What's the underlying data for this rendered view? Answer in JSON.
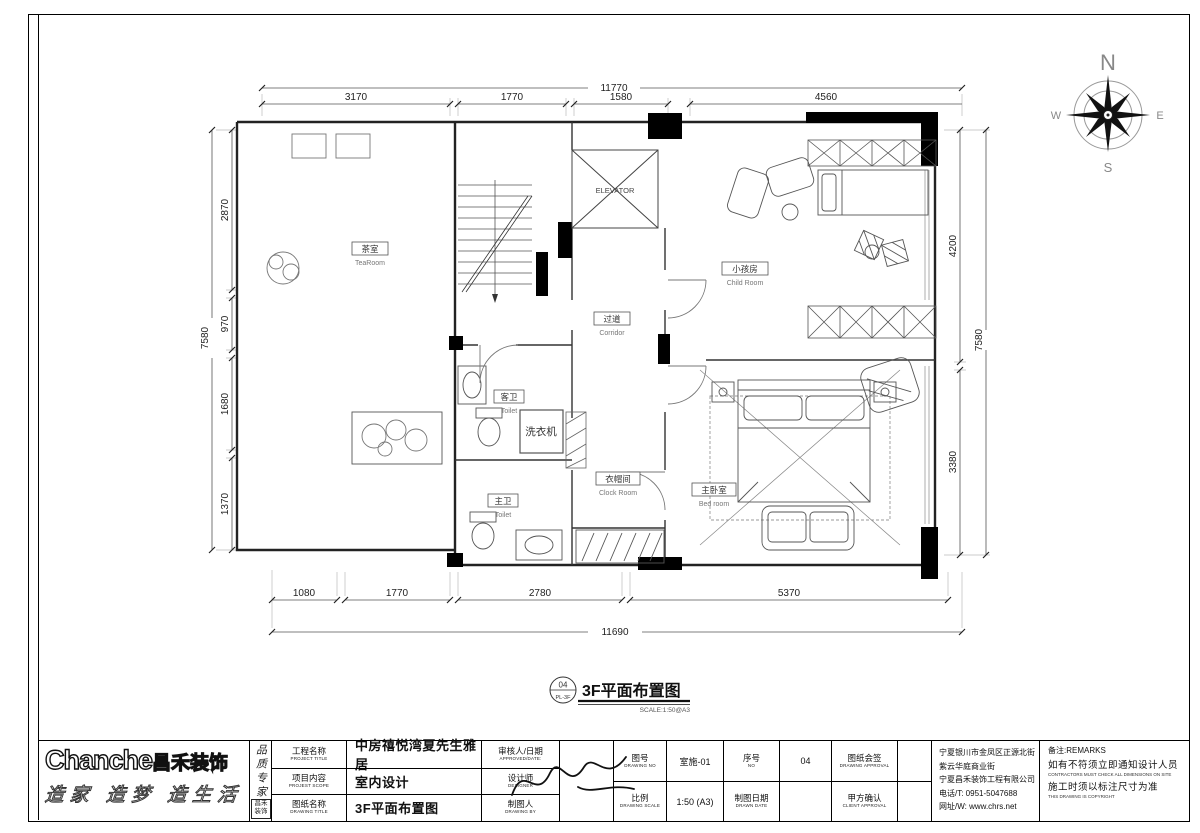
{
  "compass": {
    "n": "N",
    "e": "E",
    "s": "S",
    "w": "W"
  },
  "plan": {
    "labels": {
      "tearoom_cn": "茶室",
      "tearoom_en": "TeaRoom",
      "elevator": "ELEVATOR",
      "child_cn": "小孩房",
      "child_en": "Child Room",
      "corridor_cn": "过道",
      "corridor_en": "Corridor",
      "toilet1_cn": "客卫",
      "toilet1_en": "Toilet",
      "washer": "洗衣机",
      "toilet2_cn": "主卫",
      "toilet2_en": "Toilet",
      "cloak_cn": "衣帽间",
      "cloak_en": "Clock Room",
      "bedroom_cn": "主卧室",
      "bedroom_en": "Bed room"
    },
    "dims": {
      "top_total": "11770",
      "top_seg": [
        "3170",
        "1770",
        "1580",
        "4560"
      ],
      "bottom_total": "11690",
      "bottom_seg": [
        "1080",
        "1770",
        "2780",
        "5370"
      ],
      "left_total": "7580",
      "left_seg": [
        "2870",
        "970",
        "1680",
        "1370"
      ],
      "right_total": "7580",
      "right_seg": [
        "4200",
        "3380"
      ]
    },
    "title": {
      "num": "04",
      "code": "PL-3F",
      "text": "3F平面布置图",
      "scale": "SCALE:1:50@A3"
    }
  },
  "titleblock": {
    "logo_en": "Chanche",
    "logo_cn": "昌禾装饰",
    "slogan": "造家 造梦 造生活",
    "tagline": "品质专家",
    "seal": "昌禾装饰",
    "project_title_cn": "工程名称",
    "project_title_en": "PROJECT TITLE",
    "project_title_value": "中房禧悦湾夏先生雅居",
    "scope_cn": "项目内容",
    "scope_en": "PROJEST SCOPE",
    "scope_value": "室内设计",
    "drawing_title_cn": "图纸名称",
    "drawing_title_en": "DRAWING TITLE",
    "drawing_title_value": "3F平面布置图",
    "approved_cn": "审核人/日期",
    "approved_en": "APPROVED/DATE:",
    "designer_cn": "设计师",
    "designer_en": "DESIGNER",
    "drawn_by_cn": "制图人",
    "drawn_by_en": "DRAWING BY",
    "no_cn": "图号",
    "no_en": "DRAWING NO",
    "no_value": "室施-01",
    "serial_cn": "序号",
    "serial_en": "NO",
    "serial_value": "04",
    "sign_cn": "图纸会签",
    "sign_en": "DRAWING APPROVAL",
    "scale_cn": "比例",
    "scale_en": "DRAWING SCALE",
    "scale_value": "1:50 (A3)",
    "date_cn": "制图日期",
    "date_en": "DRAWN DATE",
    "client_cn": "甲方确认",
    "client_en": "CLIENT APPROVAL",
    "company": {
      "addr1": "宁夏银川市金凤区正源北街",
      "addr2": "紫云华庭商业街",
      "name": "宁夏昌禾装饰工程有限公司",
      "phone": "电话/T: 0951-5047688",
      "web": "网址/W: www.chrs.net"
    },
    "remarks": {
      "label": "备注:REMARKS",
      "line1": "如有不符须立即通知设计人员",
      "line1_en": "CONTRACTORS MUST CHECK ALL DIMENSIONS ON SITE",
      "line2": "施工时须以标注尺寸为准",
      "line2_en": "THIS DRAWING IS COPYRIGHT"
    }
  }
}
